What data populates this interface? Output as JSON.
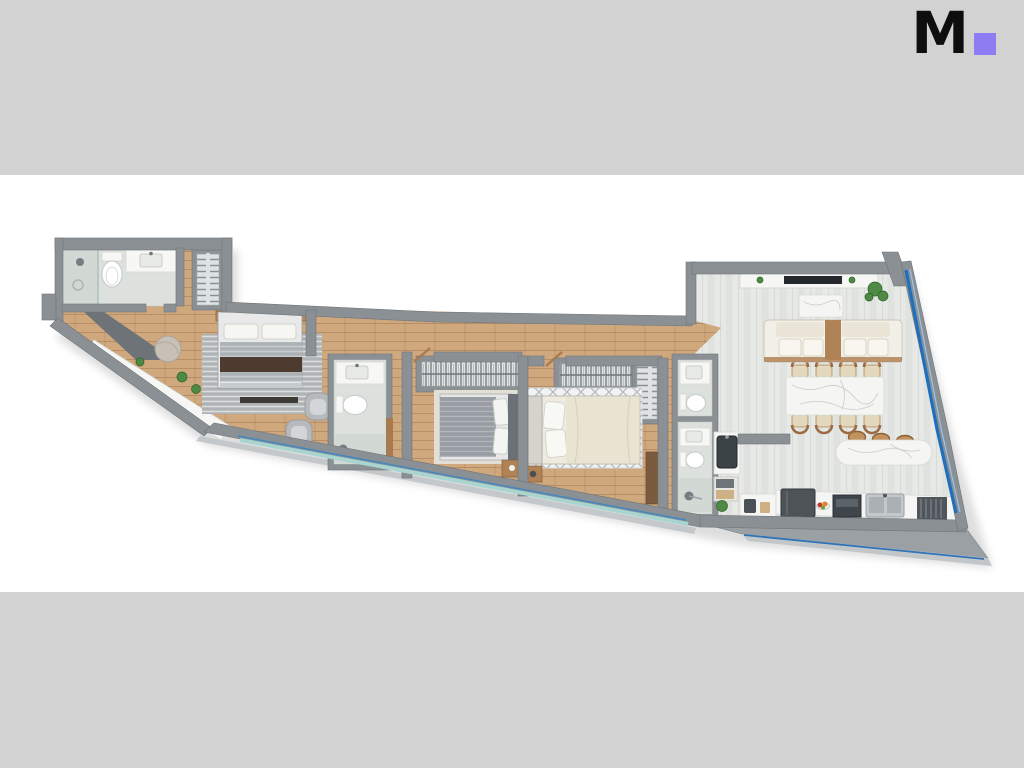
{
  "page": {
    "background": "#ffffff",
    "band_color": "#d2d2d2"
  },
  "header": {
    "logo_letter": "M",
    "logo_color": "#0e0e0e",
    "logo_square_color": "#8e7cf2"
  },
  "floor_plan": {
    "type": "apartment-3d-top-down-rendering",
    "rooms": [
      {
        "name": "main-bathroom",
        "furniture": [
          "walk-in-shower",
          "toilet",
          "vanity-sink"
        ]
      },
      {
        "name": "entry-hall",
        "furniture": [
          "coat-closet",
          "diagonal-console-shelf",
          "potted-plants",
          "round-pouf"
        ]
      },
      {
        "name": "master-bedroom",
        "furniture": [
          "double-bed",
          "silver-rug",
          "foot-bench",
          "armchair",
          "armchair"
        ]
      },
      {
        "name": "master-ensuite",
        "furniture": [
          "vanity-sink",
          "toilet",
          "shower"
        ]
      },
      {
        "name": "bedroom-2",
        "furniture": [
          "wardrobe-closet",
          "double-bed",
          "cream-rug",
          "nightstand"
        ]
      },
      {
        "name": "bedroom-3",
        "furniture": [
          "wardrobe-closet",
          "shelving-unit",
          "double-bed",
          "lattice-rug",
          "nightstand",
          "dresser"
        ]
      },
      {
        "name": "hall-bathroom",
        "furniture": [
          "vanity-sink",
          "toilet"
        ]
      },
      {
        "name": "shower-bathroom",
        "furniture": [
          "vanity-sink",
          "toilet",
          "shower"
        ]
      },
      {
        "name": "kitchen",
        "furniture": [
          "utility-sink-counter",
          "shelf-with-baskets",
          "prep-counter",
          "fridge",
          "oven",
          "double-sink",
          "dish-rack",
          "breakfast-bar-island",
          "bar-stools"
        ]
      },
      {
        "name": "dining-area",
        "furniture": [
          "marble-dining-table",
          "dining-chairs-x8"
        ]
      },
      {
        "name": "living-room",
        "furniture": [
          "media-console",
          "tv",
          "marble-coffee-table",
          "double-sofa",
          "potted-plant"
        ]
      },
      {
        "name": "balcony-terrace",
        "furniture": []
      }
    ],
    "window_glazing_sides": [
      "right-diagonal",
      "bottom-diagonal"
    ],
    "palette": {
      "wall": "#8a9094",
      "wall-dark": "#6f7579",
      "wall-light": "#bcc0c2",
      "wood": "#cfa87d",
      "tile": "#e7e9e6",
      "bath-tile": "#dde1dd",
      "shower-tile": "#d2d8d4",
      "rug-silver": "#bdc0c2",
      "rug-cream": "#e4dfd4",
      "rug-white": "#f1f2f1",
      "bed-gray": "#b3b8bd",
      "throw-brown": "#4e3b2f",
      "bed-cream": "#e9e3d1",
      "sofa-ivory": "#f2efe7",
      "wood-furniture": "#b08357",
      "marble": "#f5f6f3",
      "marble-vein": "#c7c9c7",
      "chair-tan": "#e3d7bd",
      "chair-frame": "#9c6b43",
      "appliance-dark": "#4d5357",
      "glass-blue": "#1f6fbd",
      "glass-teal": "#a9d5d0",
      "terrace": "#9aa0a4",
      "terrace-light": "#c2c6c8",
      "plant": "#4e8a43",
      "plant-dark": "#2f6129"
    }
  }
}
